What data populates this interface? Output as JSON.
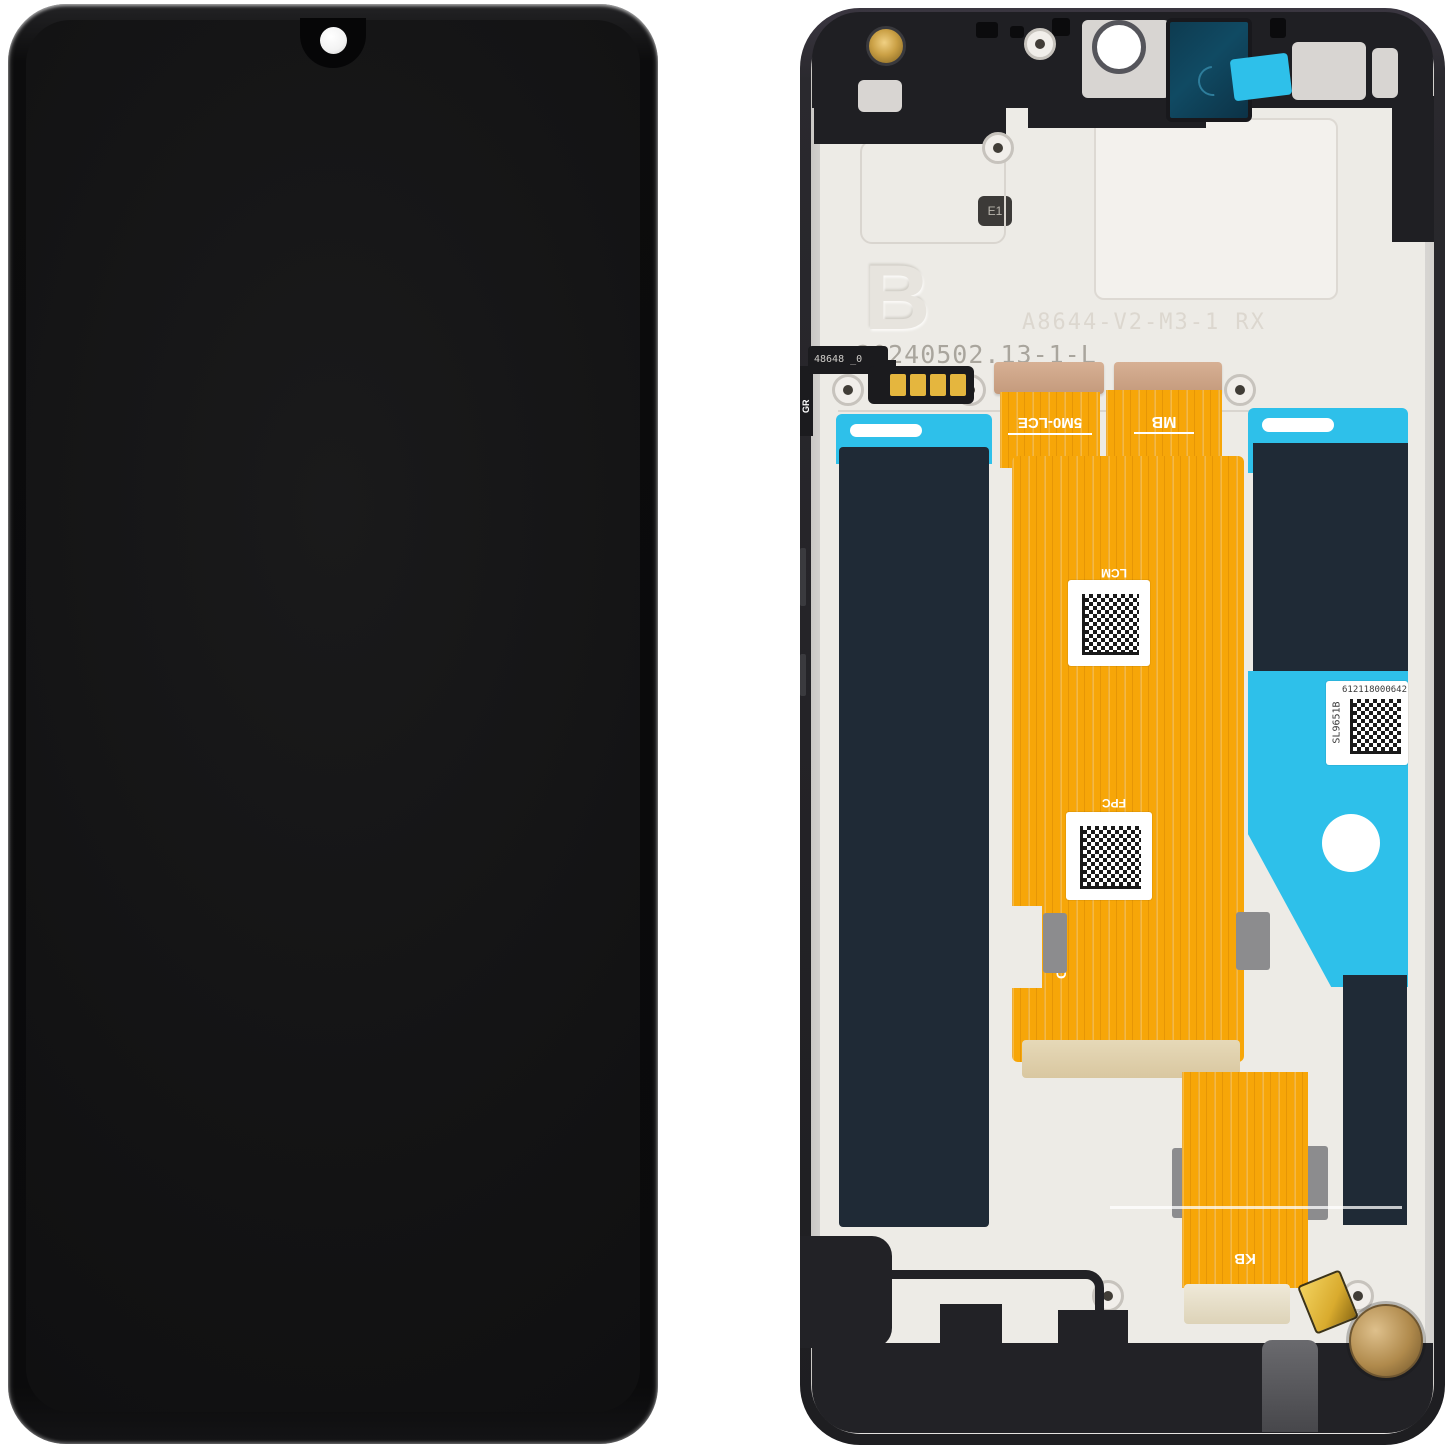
{
  "product": {
    "type": "Smartphone LCD display assembly with frame, product photo",
    "left_view": "Display front: black panel with waterdrop notch and camera hole",
    "right_view": "Display back: frame with flex cables, adhesive strips and protective tapes"
  },
  "back": {
    "engravings": {
      "plate_letter": "B",
      "batch_code": "20240502.13-1-L",
      "model_code": "A8644-V2-M3-1 RX",
      "e1_mark": "E1"
    },
    "flex_labels": {
      "lcd_cable": "5M0-LCE",
      "mainboard_cable": "MB",
      "lcm_tag": "LCM",
      "fpc_tag": "FPC",
      "keyboard_cable": "KB",
      "side_code": "C-105",
      "left_flex_code": "48648 _0",
      "left_flex_tag": "GR"
    },
    "serial_label": {
      "vertical_code": "SL9651B",
      "number": "612118000642"
    }
  },
  "colors": {
    "background": "#ffffff",
    "screen_black": "#131314",
    "frame_black": "#222226",
    "plate_cream": "#edebe6",
    "tape_cyan": "#2ec0ea",
    "adhesive_navy": "#1f2a36",
    "flex_orange": "#f7a608",
    "motor_bronze": "#b08a4c",
    "camera_window_teal": "#104a63"
  }
}
